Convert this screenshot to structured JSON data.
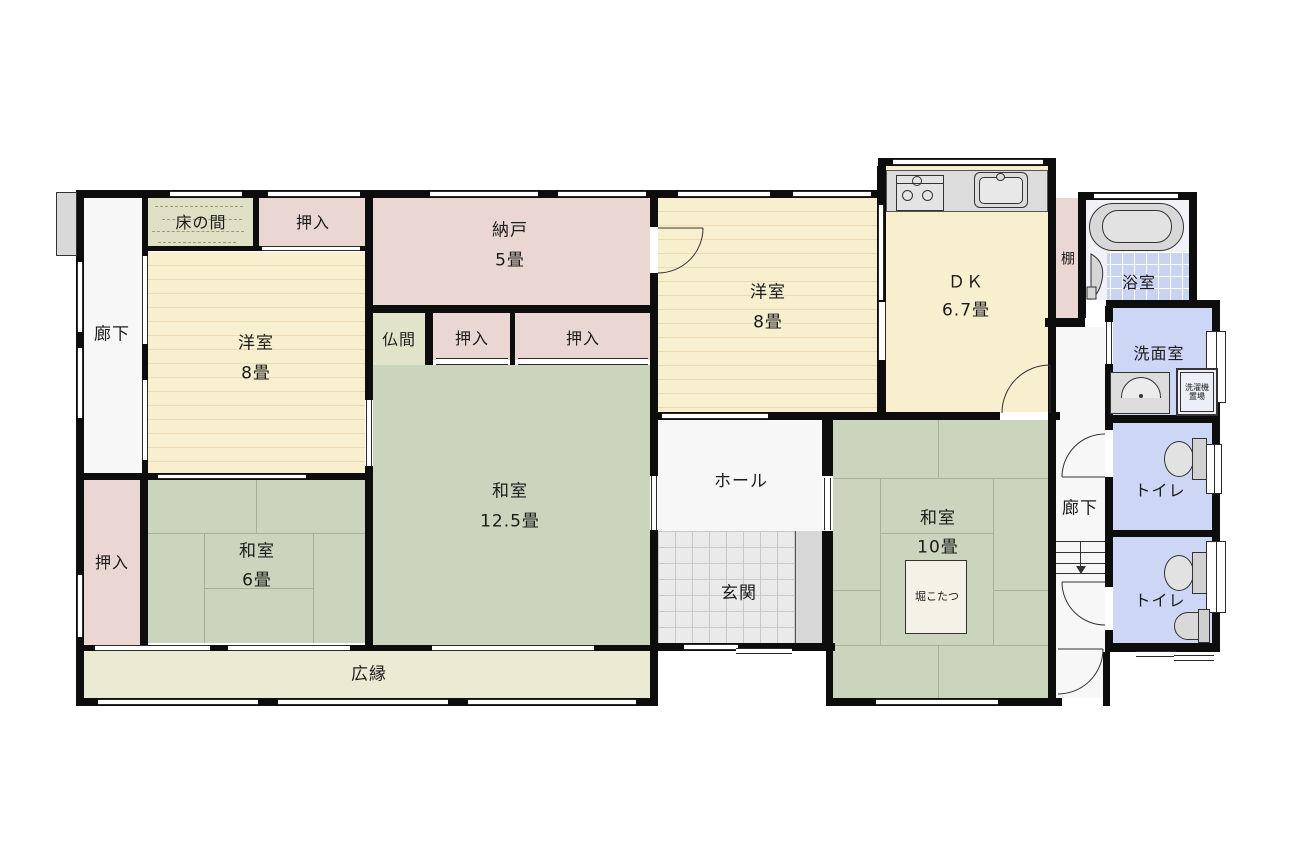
{
  "colors": {
    "wall": "#0d0d0d",
    "western": "#F8EFCF",
    "western_line": "#EADDB6",
    "closet": "#EAD7D3",
    "tatami": "#CBD4BC",
    "tatami_line": "#A8B096",
    "tokonoma": "#DFE0C4",
    "butsuma": "#E2E4C9",
    "veranda": "#EBEAD3",
    "water": "#CDD7F5",
    "bath_tile": "#C9D4F3",
    "entry_tile": "#EAEAEA",
    "corridor": "#F7F7F7",
    "fixture": "#DCDCDC",
    "step": "#D7D7D7"
  },
  "rooms": {
    "corridor_left": {
      "label": "廊下"
    },
    "corridor_right": {
      "label": "廊下"
    },
    "tokonoma": {
      "label": "床の間"
    },
    "closet_top_left": {
      "label": "押入"
    },
    "closet_a": {
      "label": "押入"
    },
    "closet_b": {
      "label": "押入"
    },
    "closet_bottom_left": {
      "label": "押入"
    },
    "western_room_1": {
      "name": "洋室",
      "size": "8畳"
    },
    "western_room_2": {
      "name": "洋室",
      "size": "8畳"
    },
    "storage_room": {
      "name": "納戸",
      "size": "5畳"
    },
    "butsuma": {
      "label": "仏間"
    },
    "dk": {
      "name": "ＤＫ",
      "size": "6.7畳"
    },
    "shelf": {
      "label": "棚"
    },
    "bathroom": {
      "label": "浴室"
    },
    "washroom": {
      "label": "洗面室"
    },
    "laundry_space": {
      "line1": "洗濯機",
      "line2": "置場"
    },
    "toilet_1": {
      "label": "トイレ"
    },
    "toilet_2": {
      "label": "トイレ"
    },
    "hall": {
      "label": "ホール"
    },
    "entrance": {
      "label": "玄関"
    },
    "japanese_room_12": {
      "name": "和室",
      "size": "12.5畳"
    },
    "japanese_room_6": {
      "name": "和室",
      "size": "6畳"
    },
    "japanese_room_10": {
      "name": "和室",
      "size": "10畳"
    },
    "kotatsu": {
      "label": "堀こたつ"
    },
    "veranda": {
      "label": "広縁"
    }
  }
}
